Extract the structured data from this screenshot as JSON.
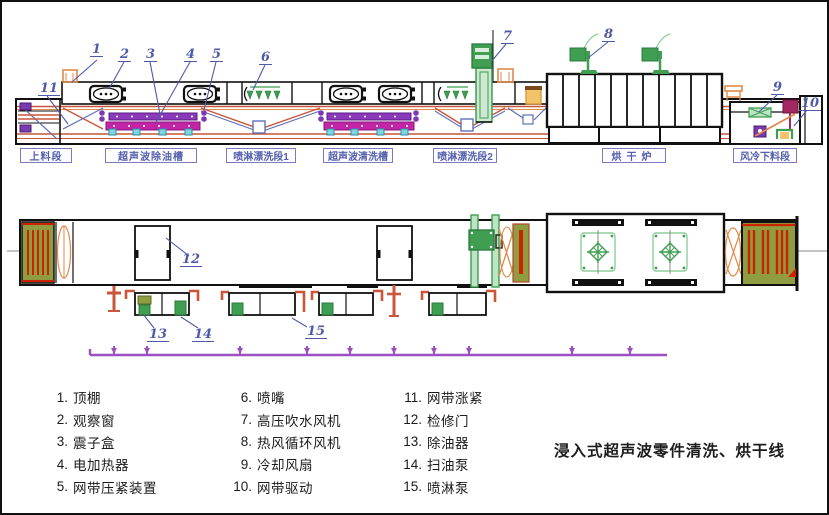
{
  "diagram_title": "浸入式超声波零件清洗、烘干线",
  "section_labels": [
    {
      "text": "上料段"
    },
    {
      "text": "超声波除油槽"
    },
    {
      "text": "喷淋漂洗段1"
    },
    {
      "text": "超声波清洗槽"
    },
    {
      "text": "喷淋漂洗段2"
    },
    {
      "text": "烘干炉"
    },
    {
      "text": "风冷下料段"
    }
  ],
  "callouts": [
    "1",
    "2",
    "3",
    "4",
    "5",
    "6",
    "7",
    "8",
    "9",
    "10",
    "11",
    "12",
    "13",
    "14",
    "15"
  ],
  "legend": {
    "col1": [
      {
        "num": "1.",
        "label": "顶棚"
      },
      {
        "num": "2.",
        "label": "观察窗"
      },
      {
        "num": "3.",
        "label": "震子盒"
      },
      {
        "num": "4.",
        "label": "电加热器"
      },
      {
        "num": "5.",
        "label": "网带压紧装置"
      }
    ],
    "col2": [
      {
        "num": "6.",
        "label": "喷嘴"
      },
      {
        "num": "7.",
        "label": "高压吹水风机"
      },
      {
        "num": "8.",
        "label": "热风循环风机"
      },
      {
        "num": "9.",
        "label": "冷却风扇"
      },
      {
        "num": "10.",
        "label": "网带驱动"
      }
    ],
    "col3": [
      {
        "num": "11.",
        "label": "网带涨紧"
      },
      {
        "num": "12.",
        "label": "检修门"
      },
      {
        "num": "13.",
        "label": "除油器"
      },
      {
        "num": "14.",
        "label": "扫油泵"
      },
      {
        "num": "15.",
        "label": "喷淋泵"
      }
    ]
  },
  "colors": {
    "callout_blue": "#4d5aa8",
    "label_purple": "#5560ad",
    "conveyor_red": "#c9553a",
    "tank_blue": "#6070b8",
    "machine_green": "#3f9e52",
    "transducer_purple": "#8a3bb8",
    "transducer_magenta": "#c226a7",
    "heater_cyan": "#7fd4e0",
    "panel_olive": "#8f9c3f",
    "fixture_orange": "#e08a4a",
    "drive_crimson": "#a12860",
    "manifold_violet": "#9b4fc0"
  }
}
